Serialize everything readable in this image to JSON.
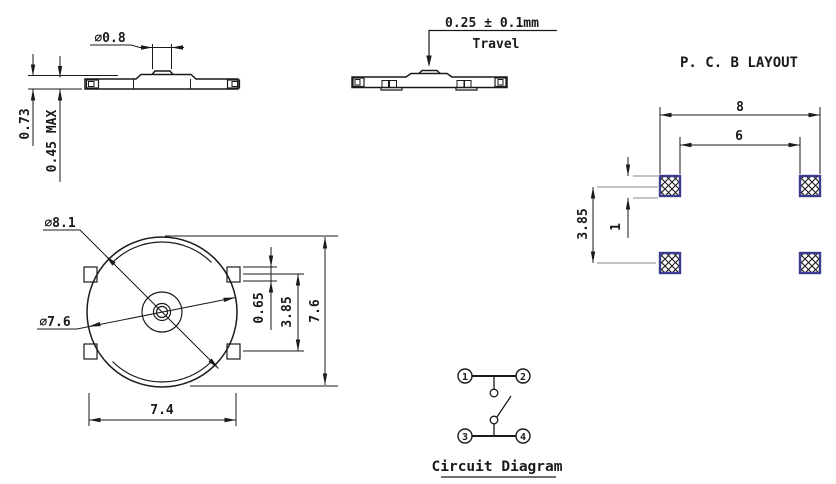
{
  "side_view": {
    "stem_dia": "∅0.8",
    "height": "0.73",
    "height_max": "0.45 MAX"
  },
  "travel_view": {
    "travel_value": "0.25 ± 0.1mm",
    "travel_label": "Travel"
  },
  "pcb_layout": {
    "title": "P. C. B LAYOUT",
    "outer_span": "8",
    "inner_span": "6",
    "pad_height": "1",
    "row_pitch": "3.85"
  },
  "top_view": {
    "flange_dia": "∅8.1",
    "body_dia": "∅7.6",
    "tab_height": "0.65",
    "tab_pitch": "3.85",
    "overall_height": "7.6",
    "overall_width": "7.4"
  },
  "circuit_diagram": {
    "title": "Circuit Diagram",
    "terminals": [
      "1",
      "2",
      "3",
      "4"
    ]
  },
  "colors": {
    "line": "#1a1a1a",
    "extension_line": "#8a8a8a",
    "pad_border": "#3b3b8f",
    "pad_hatch": "#1a1a1a"
  }
}
